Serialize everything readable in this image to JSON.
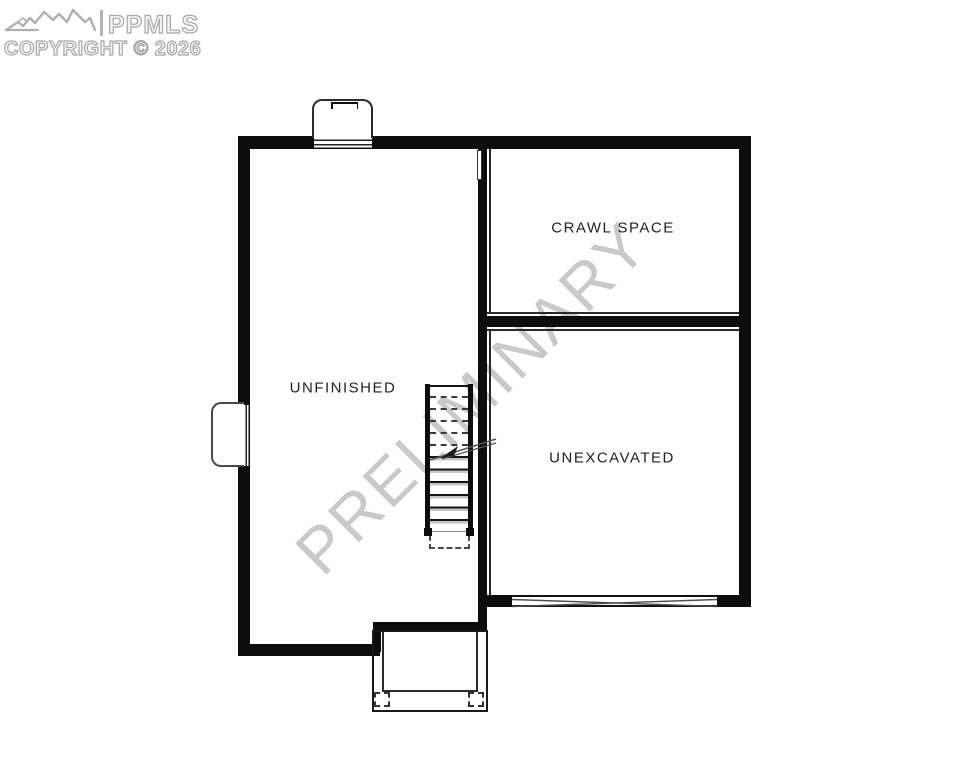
{
  "branding": {
    "mls_name": "PPMLS",
    "copyright_line": "COPYRIGHT © 2026",
    "icon": "mountain-range-icon",
    "outline_color": "#a9a9a9"
  },
  "watermark": {
    "text": "PRELIMINARY",
    "color": "#c9c9c9",
    "rotation_deg": -45
  },
  "floorplan": {
    "rooms": {
      "unfinished": {
        "label": "UNFINISHED"
      },
      "crawl_space": {
        "label": "CRAWL SPACE"
      },
      "unexcavated": {
        "label": "UNEXCAVATED"
      }
    },
    "features": {
      "stairs": "staircase-with-break-line",
      "top_window": "window-with-window-well",
      "left_window": "window-with-window-well",
      "bottom_opening": "x-braced-foundation-opening",
      "porch": "porch-footprint-with-posts"
    }
  },
  "colors": {
    "wall": "#0d0d0d",
    "thin_line": "#2a2a2a",
    "watermark": "#c9c9c9",
    "label_text": "#222222",
    "background": "#ffffff"
  }
}
